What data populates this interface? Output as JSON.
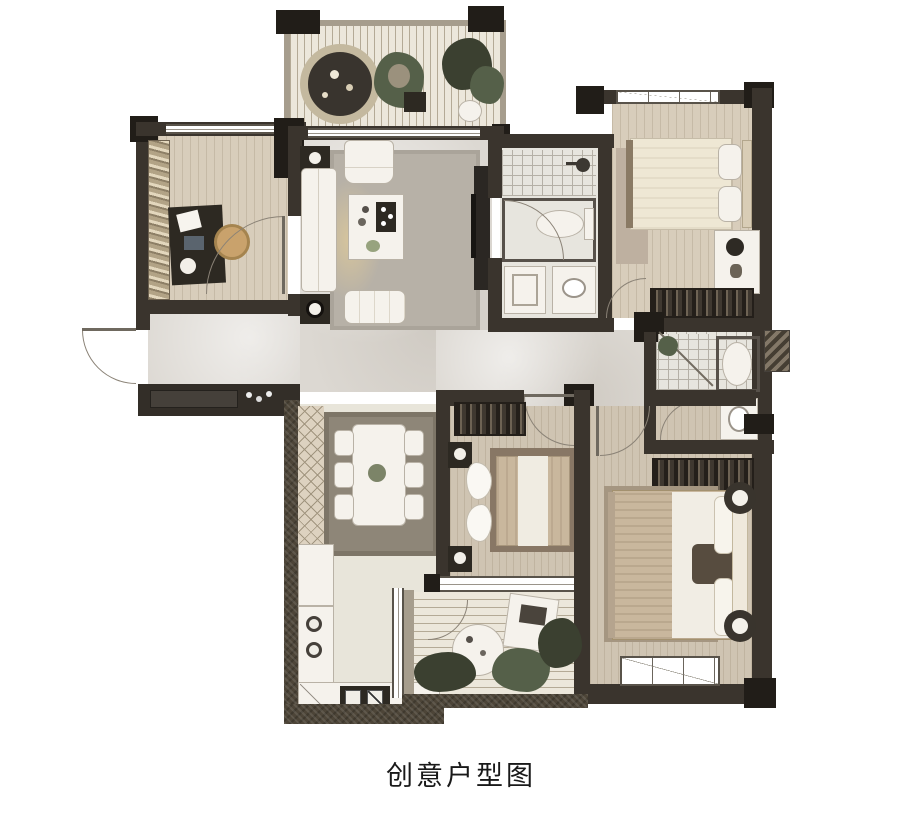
{
  "caption": "创意户型图",
  "palette": {
    "wall": "#3a342d",
    "pillar": "#211d18",
    "speck": "#4d4538",
    "wood": "#d8cdbb",
    "wood2": "#cfc4b2",
    "marble": "#dcd8d2",
    "deck": "#ece7db",
    "deckline": "#b4aa96",
    "tilefloor": "#e7e5de",
    "tileline": "#b5b0a6",
    "rugliving": "#b7b1a7",
    "rugdining": "#8e8678",
    "rugmaster": "#a59681",
    "rugbed2": "#887765",
    "rugbed1": "#beb0a0",
    "furnwhite": "#f5f2ec",
    "furnline": "#b9b2a6",
    "darkfurn": "#2d2922",
    "plant": "#3b4030",
    "plant2": "#556049",
    "glow": "#e7cf96",
    "arc": "#8a8276",
    "bedcream": "#eee7d4",
    "bedtan": "#c9b79d"
  },
  "rooms": [
    {
      "name": "top-terrace",
      "features": [
        "round-fire-table",
        "plants",
        "teddy-bear",
        "wood-deck"
      ]
    },
    {
      "name": "study",
      "features": [
        "bookshelf",
        "desk",
        "office-chair",
        "window",
        "door"
      ]
    },
    {
      "name": "living-room",
      "features": [
        "sofa",
        "armchair",
        "coffee-table",
        "tv-console",
        "side-tables",
        "bench",
        "area-rug"
      ]
    },
    {
      "name": "bathroom-main",
      "features": [
        "shower",
        "toilet",
        "double-vanity",
        "door"
      ]
    },
    {
      "name": "bedroom-north",
      "features": [
        "double-bed",
        "desk",
        "wardrobe",
        "window",
        "door"
      ]
    },
    {
      "name": "ensuite-bathroom",
      "features": [
        "shower",
        "toilet",
        "vanity",
        "door"
      ]
    },
    {
      "name": "dining-room",
      "features": [
        "dining-table",
        "six-chairs",
        "area-rug",
        "tiled-band"
      ]
    },
    {
      "name": "kitchen",
      "features": [
        "l-shaped-counter",
        "cooktop",
        "double-sink"
      ]
    },
    {
      "name": "bedroom-middle",
      "features": [
        "double-bed",
        "wardrobe",
        "nightstands",
        "sliding-window"
      ]
    },
    {
      "name": "master-bedroom",
      "features": [
        "king-bed",
        "wardrobe",
        "nightstands",
        "window",
        "door"
      ]
    },
    {
      "name": "south-balcony",
      "features": [
        "wood-deck",
        "round-table",
        "lounge-chair",
        "plants",
        "door"
      ]
    },
    {
      "name": "entry",
      "features": [
        "entry-door",
        "console-cabinet"
      ]
    }
  ]
}
